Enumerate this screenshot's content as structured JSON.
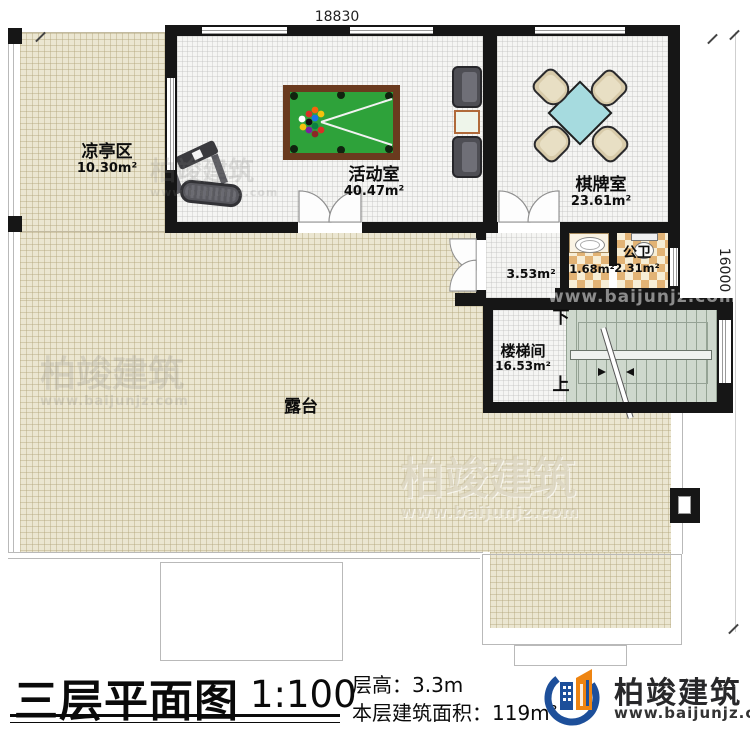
{
  "meta": {
    "plan_title": "三层平面图",
    "scale": "1:100",
    "floor_height": "层高：3.3m",
    "floor_area": "本层建筑面积：119m²"
  },
  "dimensions": {
    "top": "18830",
    "right": "16000"
  },
  "rooms": [
    {
      "name": "凉亭区",
      "area": "10.30m²"
    },
    {
      "name": "活动室",
      "area": "40.47m²"
    },
    {
      "name": "棋牌室",
      "area": "23.61m²"
    },
    {
      "name": "",
      "area": "1.68m²"
    },
    {
      "name": "公卫",
      "area": "2.31m²"
    },
    {
      "name": "",
      "area": "3.53m²"
    },
    {
      "name": "楼梯间",
      "area": "16.53m²"
    },
    {
      "name": "露台",
      "area": ""
    }
  ],
  "stairs": {
    "down_label": "下",
    "up_label": "上"
  },
  "brand": {
    "name": "柏竣建筑",
    "url": "www.baijunjz.com",
    "blue": "#1d4f9a",
    "orange": "#ee8411"
  },
  "watermark": {
    "name": "柏竣建筑",
    "url": "www.baijunjz.com"
  }
}
